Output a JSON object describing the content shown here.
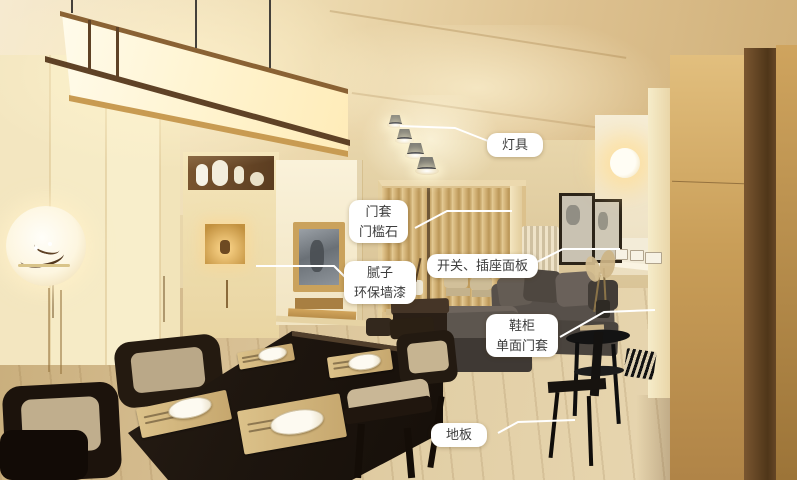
{
  "annotations": [
    {
      "id": "lighting",
      "text": "灯具"
    },
    {
      "id": "door-frame",
      "text": "门套\n门槛石"
    },
    {
      "id": "putty-paint",
      "text": "腻子\n环保墙漆"
    },
    {
      "id": "switch-socket",
      "text": "开关、插座面板"
    },
    {
      "id": "shoe-cabinet",
      "text": "鞋柜\n单面门套"
    },
    {
      "id": "floor",
      "text": "地板"
    }
  ],
  "colors": {
    "label_background": "#ffffff",
    "label_text": "#3d3d3d",
    "leader_line": "#ffffff"
  },
  "scene_objects": [
    "pendant-lantern",
    "ceiling-spotlights",
    "display-niche",
    "wardrobe",
    "tv-wall",
    "curtains",
    "radiator",
    "wall-art",
    "wall-sconce",
    "switch-socket-panels",
    "sofa",
    "shoe-cabinet-side-table",
    "dining-table",
    "dining-chairs",
    "wood-floor",
    "tall-wood-cabinet"
  ]
}
